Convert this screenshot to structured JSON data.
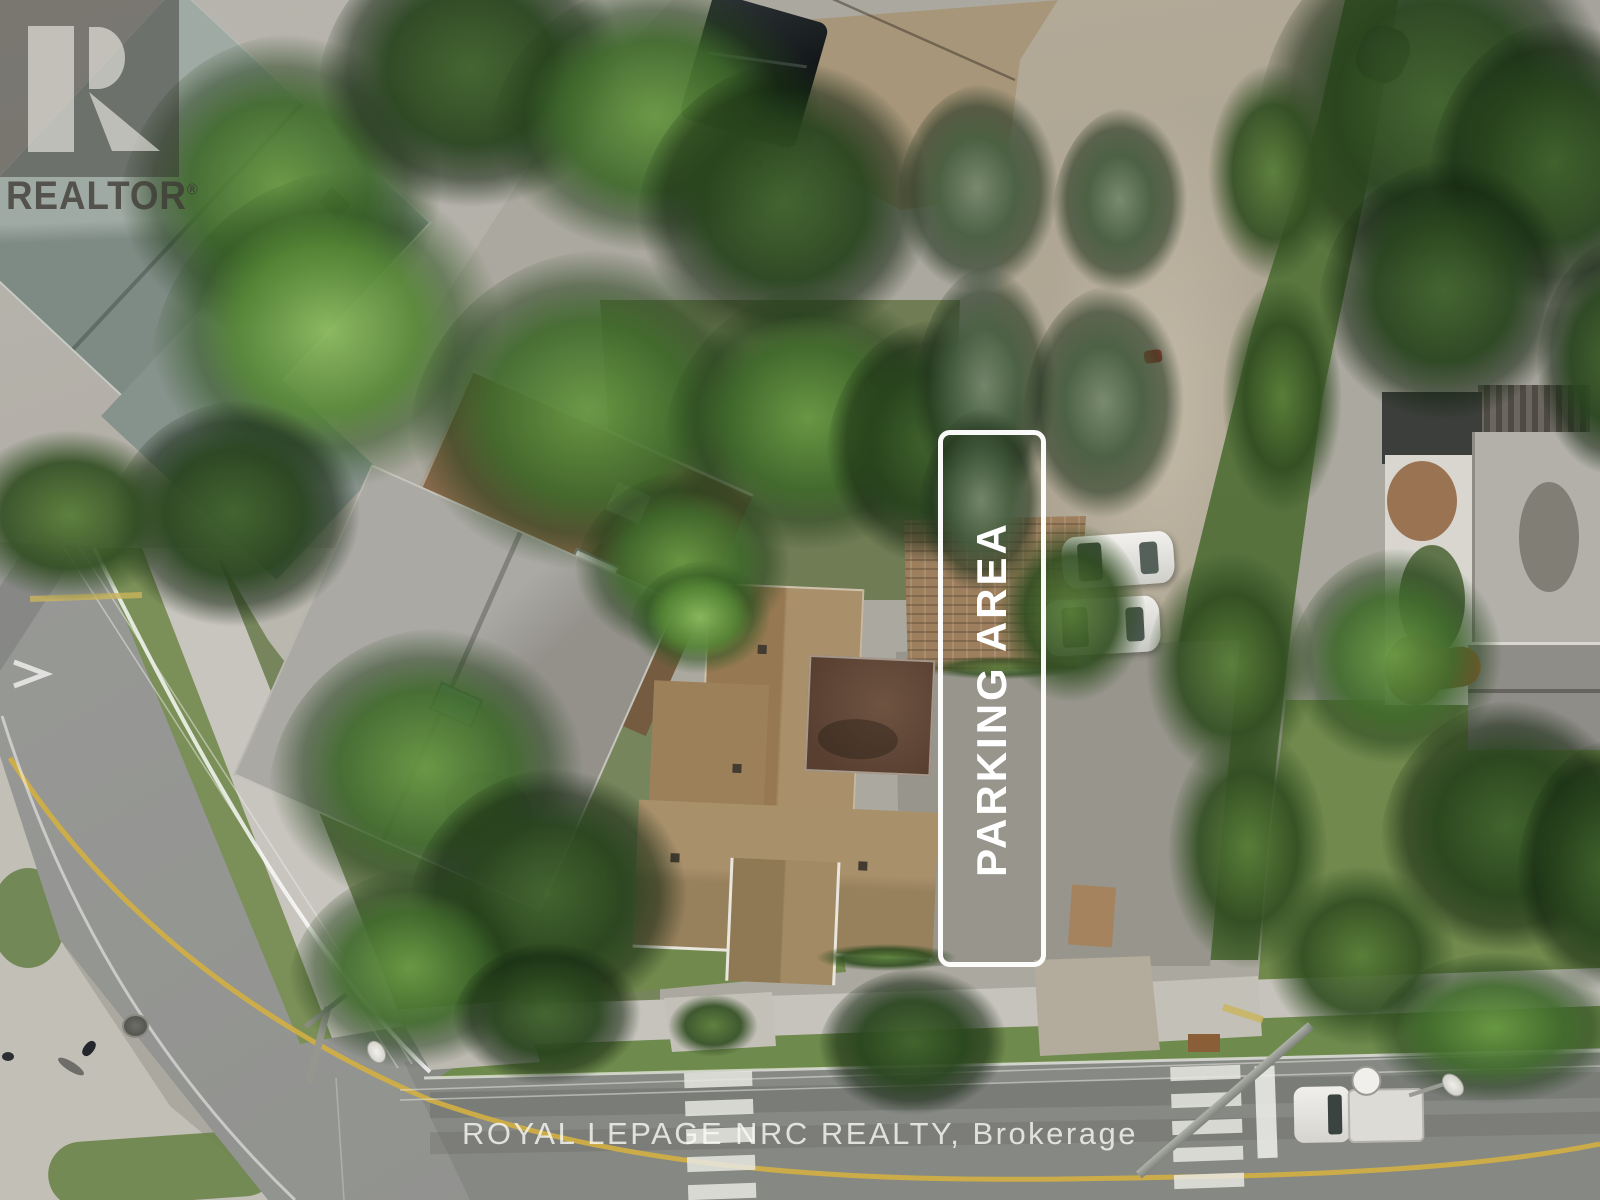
{
  "annotations": {
    "parking_area": {
      "label": "PARKING AREA",
      "outline_color": "#ffffff",
      "label_color": "#ffffff"
    }
  },
  "watermarks": {
    "realtor_logo": {
      "letter": "R",
      "wordmark": "REALTOR",
      "registered_symbol": "®"
    },
    "brokerage_line": {
      "text": "ROYAL LEPAGE NRC REALTY, Brokerage",
      "color": "#ffffff"
    }
  },
  "road_markings": {
    "center_line_color": "#cfae46",
    "crosswalk_color": "#e8e7e1"
  }
}
